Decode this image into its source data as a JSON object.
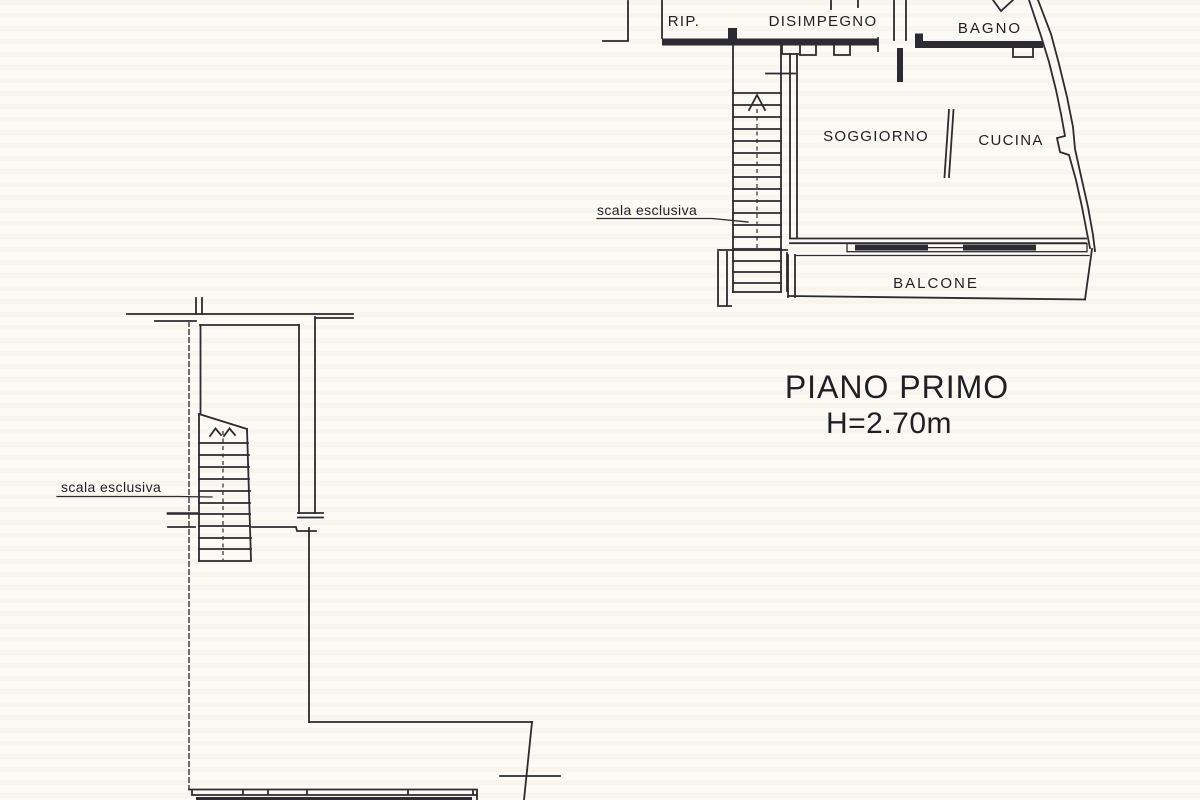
{
  "page": {
    "description": "Scanned architectural floor plan sheet",
    "paper_color": "#fbfaf5",
    "ink_color": "#2b2b31"
  },
  "upper_plan": {
    "labels": {
      "rip": "RIP.",
      "disimpegno": "DISIMPEGNO",
      "bagno": "BAGNO",
      "soggiorno": "SOGGIORNO",
      "cucina": "CUCINA",
      "balcone": "BALCONE",
      "scala": "scala esclusiva"
    }
  },
  "lower_plan": {
    "labels": {
      "scala": "scala esclusiva"
    }
  },
  "caption": {
    "line1": "PIANO PRIMO",
    "line2": "H=2.70m"
  }
}
